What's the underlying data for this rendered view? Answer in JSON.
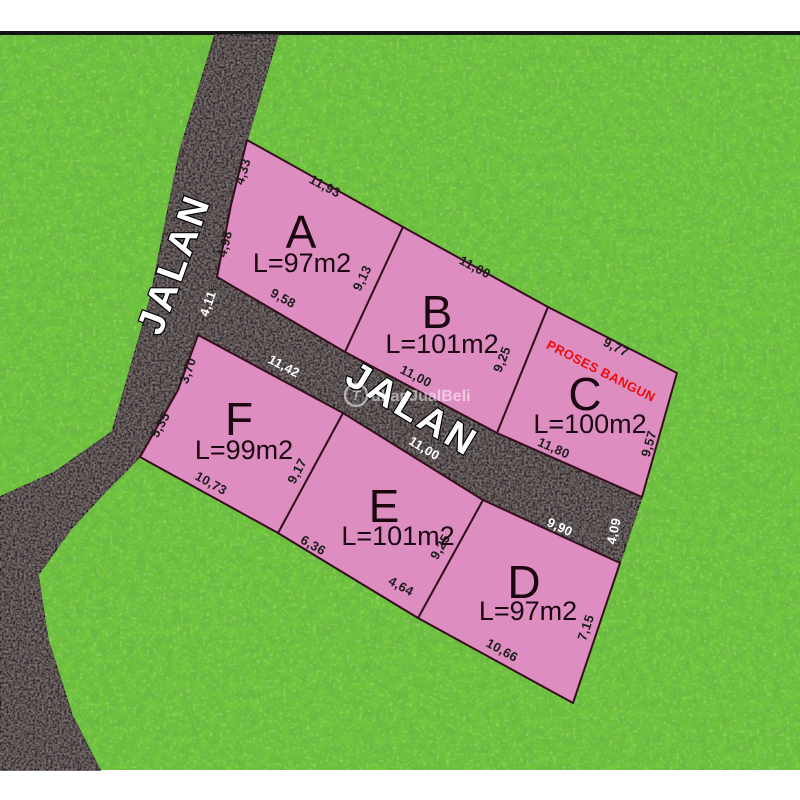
{
  "watermark": {
    "symbol": "T",
    "text": "ubanJualBeli"
  },
  "roads": {
    "vertical_label": "JALAN",
    "horizontal_label": "JALAN",
    "junction_width": "4,11",
    "end_width": "4,09"
  },
  "plots": {
    "A": {
      "label": "A",
      "area": "L=97m2",
      "dims": {
        "left_top": "4,33",
        "top": "11,93",
        "left_bottom": "4,98",
        "bottom": "9,58",
        "right": "9,13"
      }
    },
    "B": {
      "label": "B",
      "area": "L=101m2",
      "dims": {
        "top": "11,00",
        "right": "9,25",
        "bottom": "11,00"
      }
    },
    "C": {
      "label": "C",
      "area": "L=100m2",
      "status": "PROSES BANGUN",
      "dims": {
        "top": "9,77",
        "right": "9,57",
        "bottom": "11,80"
      }
    },
    "D": {
      "label": "D",
      "area": "L=97m2",
      "dims": {
        "top": "9,90",
        "right": "7,15",
        "bottom": "10,66"
      }
    },
    "E": {
      "label": "E",
      "area": "L=101m2",
      "dims": {
        "top": "11,00",
        "right": "9,25",
        "bottom_left": "6,36",
        "bottom_right": "4,64"
      }
    },
    "F": {
      "label": "F",
      "area": "L=99m2",
      "dims": {
        "top": "11,42",
        "left_top": "3,70",
        "left_bottom": "5,35",
        "bottom": "10,73",
        "right": "9,17"
      }
    }
  },
  "colors": {
    "grass": "#71c73d",
    "road": "#332a2d",
    "plot_fill": "#de8dc1",
    "plot_border": "#350f1d",
    "status_red": "#ee0c0c"
  }
}
